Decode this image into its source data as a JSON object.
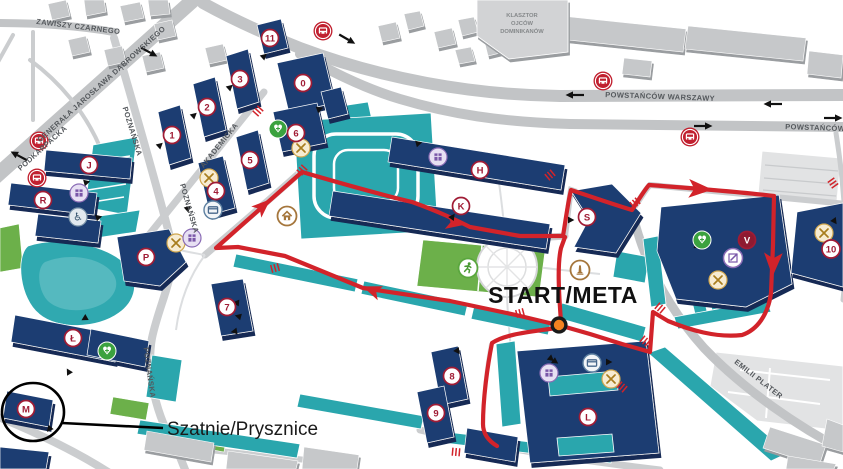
{
  "labels": {
    "start_meta": "START/META",
    "locker_rooms": "Szatnie/Prysznice"
  },
  "landmark": {
    "line1": "KLASZTOR",
    "line2": "OJCÓW",
    "line3": "DOMINIKANÓW"
  },
  "streets": [
    {
      "name": "ZAWISZY CZARNEGO"
    },
    {
      "name": "GENERAŁA JAROSŁAWA DĄBROWSKIEGO"
    },
    {
      "name": "PODKARPACKA"
    },
    {
      "name": "POZNAŃSKA"
    },
    {
      "name": "POZNAŃSKA"
    },
    {
      "name": "POZNAŃSKA"
    },
    {
      "name": "AKADEMICKA"
    },
    {
      "name": "POWSTAŃCÓW WARSZAWY"
    },
    {
      "name": "POWSTAŃCÓW WARSZAWY"
    },
    {
      "name": "EMILII PLATER"
    }
  ],
  "buildings": [
    {
      "label": "0"
    },
    {
      "label": "1"
    },
    {
      "label": "2"
    },
    {
      "label": "3"
    },
    {
      "label": "4"
    },
    {
      "label": "5"
    },
    {
      "label": "6"
    },
    {
      "label": "7"
    },
    {
      "label": "8"
    },
    {
      "label": "9"
    },
    {
      "label": "10"
    },
    {
      "label": "11"
    },
    {
      "label": "H"
    },
    {
      "label": "K"
    },
    {
      "label": "S"
    },
    {
      "label": "V"
    },
    {
      "label": "L"
    },
    {
      "label": "Ł"
    },
    {
      "label": "M"
    },
    {
      "label": "P"
    },
    {
      "label": "J"
    },
    {
      "label": "R"
    }
  ],
  "icons": {
    "bus": "bus-stop",
    "restaurant": "food-service",
    "library": "library",
    "atm": "atm-cash-machine",
    "wheelchair": "accessible-entrance",
    "medical": "first-aid",
    "runner": "sports-field",
    "home": "dormitory",
    "monument": "monument",
    "pencil": "registry-office",
    "start_dot": "start-finish-point",
    "entrance_arrow": "building-entrance",
    "road_closed": "road-closure-mark"
  },
  "colors": {
    "route": "#d2232a",
    "start_marker": "#f58220",
    "campus_building": "#1c3e72",
    "walkway_teal": "#2aa6ad",
    "badge_ring": "#a01c35",
    "road_gray": "#c2c4c6",
    "field_green": "#4fa52f",
    "water_teal": "#30a9b0"
  }
}
